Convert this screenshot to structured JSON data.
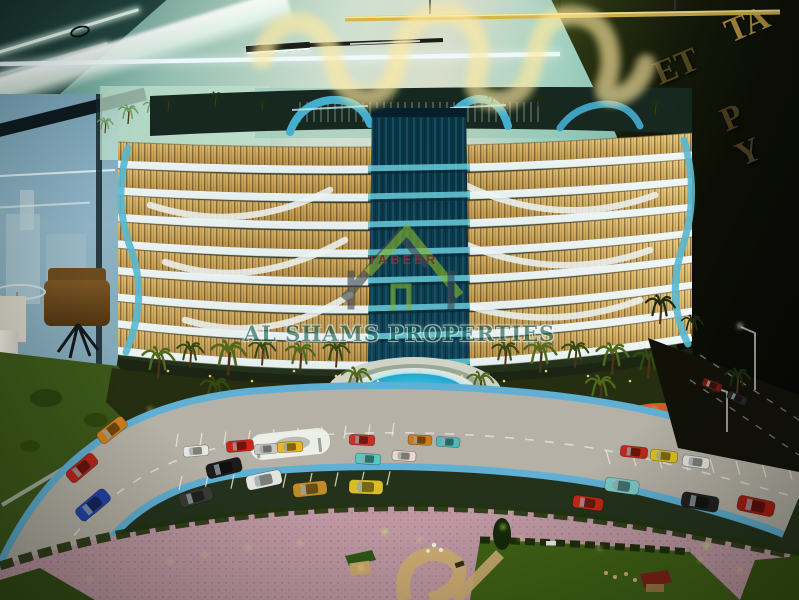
{
  "watermark": {
    "brand": "TABEER",
    "company": "AL SHAMS PROPERTIES",
    "brand_color": "#b5342a",
    "company_color": "#175c54",
    "roof_green": "#86b42c",
    "frame_gray": "#3f4a52"
  },
  "wall_sign": {
    "fragment_top": "ET",
    "fragment_gold": "TA",
    "fragment_bottom": "P Y",
    "letter_color": "#56481f",
    "gold_color": "#b89440"
  },
  "palette": {
    "ceiling_teal": "#7fb3a6",
    "cove_white": "#f6fff6",
    "wall_dark": "#0c0e06",
    "window_glow": "#f0d084",
    "window_glow_deep": "#b8904a",
    "balcony_white": "#e3edee",
    "core_teal_top": "#0a3242",
    "core_teal": "#0d4254",
    "bridge_teal": "#63c2d2",
    "canopy_blue": "#45aecd",
    "end_wave_blue": "#58b8d0",
    "pool_cyan": "#35c8e8",
    "pool_deep": "#0878a8",
    "road_gray": "#b6b1a6",
    "curb_blue": "#5fb0d4",
    "pavement_pink": "#bf98a3",
    "lawn_green": "#3f5c19",
    "podium_green": "#252e10",
    "neon_warm": "#fff3c9",
    "neon_gold": "#d8b44a",
    "neon_white_tube": "#f2fbff",
    "ground_light": "#ffd880",
    "accent_green_light": "#c6ff5a",
    "track_orange": "#cc5f28"
  },
  "building": {
    "floor_count": 8,
    "left_x": 118,
    "right_x": 692
  },
  "cars": [
    {
      "x": 112,
      "y": 430,
      "r": -38,
      "s": 0.95,
      "c": "#d08018"
    },
    {
      "x": 82,
      "y": 468,
      "r": -40,
      "s": 1.0,
      "c": "#b82418"
    },
    {
      "x": 93,
      "y": 505,
      "r": -40,
      "s": 1.1,
      "c": "#2244aa"
    },
    {
      "x": 196,
      "y": 451,
      "r": -5,
      "s": 0.75,
      "c": "#e8e6e0"
    },
    {
      "x": 240,
      "y": 446,
      "r": -5,
      "s": 0.8,
      "c": "#cc2418"
    },
    {
      "x": 266,
      "y": 449,
      "r": -4,
      "s": 0.7,
      "c": "#c8c6c0"
    },
    {
      "x": 290,
      "y": 447,
      "r": -3,
      "s": 0.75,
      "c": "#e8b820"
    },
    {
      "x": 362,
      "y": 440,
      "r": 3,
      "s": 0.75,
      "c": "#c83028"
    },
    {
      "x": 368,
      "y": 459,
      "r": 4,
      "s": 0.75,
      "c": "#58c8c0"
    },
    {
      "x": 404,
      "y": 456,
      "r": 4,
      "s": 0.7,
      "c": "#e8d8d0"
    },
    {
      "x": 420,
      "y": 440,
      "r": 3,
      "s": 0.7,
      "c": "#cc7a1a"
    },
    {
      "x": 448,
      "y": 442,
      "r": 4,
      "s": 0.7,
      "c": "#50b8b8"
    },
    {
      "x": 224,
      "y": 468,
      "r": -14,
      "s": 1.05,
      "c": "#1c1c1c"
    },
    {
      "x": 264,
      "y": 480,
      "r": -12,
      "s": 1.05,
      "c": "#e2e4e0"
    },
    {
      "x": 310,
      "y": 489,
      "r": -6,
      "s": 1.0,
      "c": "#c08a28"
    },
    {
      "x": 196,
      "y": 497,
      "r": -16,
      "s": 1.0,
      "c": "#3a3a38"
    },
    {
      "x": 366,
      "y": 487,
      "r": 2,
      "s": 1.0,
      "c": "#d8bc28"
    },
    {
      "x": 588,
      "y": 503,
      "r": 8,
      "s": 0.9,
      "c": "#c02818"
    },
    {
      "x": 622,
      "y": 486,
      "r": 8,
      "s": 1.0,
      "c": "#7ac8c8"
    },
    {
      "x": 700,
      "y": 502,
      "r": 10,
      "s": 1.1,
      "c": "#202020"
    },
    {
      "x": 756,
      "y": 506,
      "r": 12,
      "s": 1.1,
      "c": "#a81c10"
    },
    {
      "x": 634,
      "y": 452,
      "r": 6,
      "s": 0.8,
      "c": "#c02818"
    },
    {
      "x": 664,
      "y": 456,
      "r": 7,
      "s": 0.8,
      "c": "#e0c020"
    },
    {
      "x": 696,
      "y": 462,
      "r": 8,
      "s": 0.8,
      "c": "#e6e4de"
    },
    {
      "x": 712,
      "y": 385,
      "r": 22,
      "s": 0.6,
      "c": "#6a1a10"
    },
    {
      "x": 737,
      "y": 398,
      "r": 25,
      "s": 0.6,
      "c": "#26262a"
    }
  ],
  "palms": {
    "podium": [
      [
        158,
        372,
        1.1
      ],
      [
        190,
        362,
        0.9
      ],
      [
        228,
        368,
        1.2
      ],
      [
        262,
        360,
        0.9
      ],
      [
        300,
        366,
        1.0
      ],
      [
        336,
        362,
        0.9
      ],
      [
        356,
        390,
        1.0
      ],
      [
        505,
        362,
        0.9
      ],
      [
        540,
        366,
        1.1
      ],
      [
        575,
        362,
        0.9
      ],
      [
        612,
        368,
        1.1
      ],
      [
        648,
        372,
        1.0
      ],
      [
        480,
        392,
        0.9
      ],
      [
        215,
        400,
        1.0
      ],
      [
        600,
        398,
        1.0
      ]
    ],
    "roof": [
      [
        168,
        108,
        0.7
      ],
      [
        215,
        104,
        0.8
      ],
      [
        262,
        108,
        0.6
      ],
      [
        392,
        100,
        0.7
      ],
      [
        492,
        100,
        0.8
      ],
      [
        538,
        104,
        0.6
      ],
      [
        655,
        112,
        0.8
      ]
    ],
    "backdrop": [
      [
        128,
        120,
        1.0
      ],
      [
        105,
        130,
        0.8
      ],
      [
        152,
        114,
        0.9
      ]
    ],
    "roadside": [
      [
        660,
        318,
        1.5
      ],
      [
        692,
        332,
        1.1
      ],
      [
        737,
        388,
        1.3
      ]
    ]
  }
}
